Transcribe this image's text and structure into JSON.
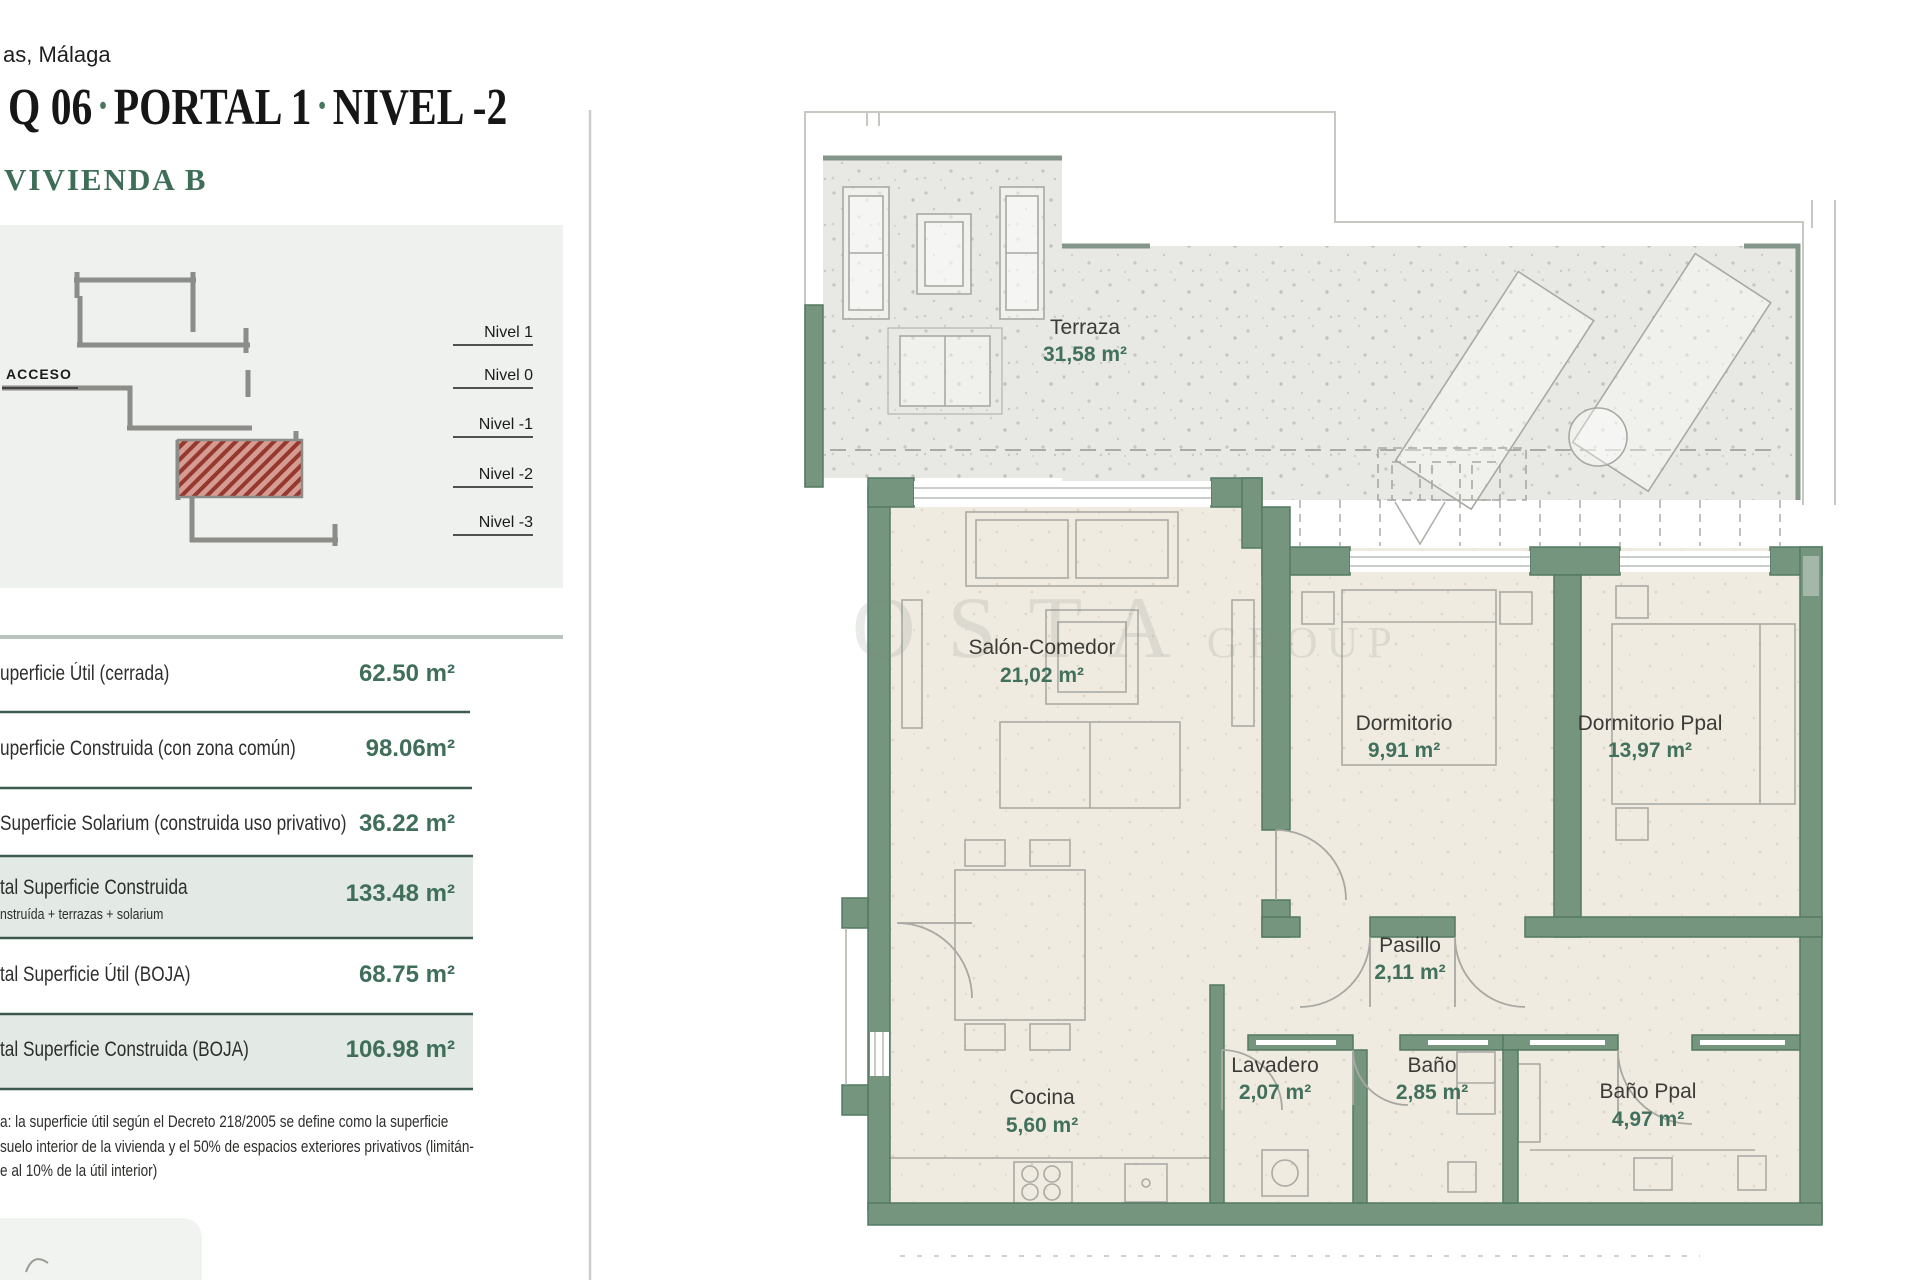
{
  "header": {
    "location": "as, Málaga",
    "title_parts": [
      "Q 06",
      "PORTAL 1",
      "NIVEL -2"
    ],
    "separator": "·",
    "unit": "VIVIENDA B"
  },
  "section_diagram": {
    "acceso_label": "ACCESO",
    "levels": [
      "Nivel 1",
      "Nivel 0",
      "Nivel -1",
      "Nivel -2",
      "Nivel -3"
    ],
    "highlighted_level": "Nivel -2"
  },
  "areas_table": {
    "rows": [
      {
        "label": "uperficie Útil (cerrada)",
        "value": "62.50 m²",
        "highlight": false
      },
      {
        "label": "uperficie Construida (con zona común)",
        "value": "98.06m²",
        "highlight": false
      },
      {
        "label": "Superficie Solarium (construida uso privativo)",
        "value": "36.22 m²",
        "highlight": false
      },
      {
        "label": "tal Superficie Construida",
        "sublabel": "nstruída + terrazas + solarium",
        "value": "133.48 m²",
        "highlight": true
      },
      {
        "label": "tal Superficie Útil (BOJA)",
        "value": "68.75 m²",
        "highlight": false
      },
      {
        "label": "tal Superficie Construida (BOJA)",
        "value": "106.98 m²",
        "highlight": true
      }
    ]
  },
  "footnote_lines": [
    "a: la superficie útil según el Decreto 218/2005 se define como la superficie",
    "suelo interior de la vivienda y el 50% de espacios exteriores privativos (limitán-",
    "e al 10% de la útil interior)"
  ],
  "watermark": {
    "big": "OSTA",
    "small": "GROUP"
  },
  "plan": {
    "rooms": [
      {
        "name": "Terraza",
        "area": "31,58 m²"
      },
      {
        "name": "Salón-Comedor",
        "area": "21,02 m²"
      },
      {
        "name": "Dormitorio",
        "area": "9,91 m²"
      },
      {
        "name": "Dormitorio Ppal",
        "area": "13,97 m²"
      },
      {
        "name": "Pasillo",
        "area": "2,11 m²"
      },
      {
        "name": "Cocina",
        "area": "5,60 m²"
      },
      {
        "name": "Lavadero",
        "area": "2,07 m²"
      },
      {
        "name": "Baño",
        "area": "2,85 m²"
      },
      {
        "name": "Baño Ppal",
        "area": "4,97 m²"
      }
    ]
  },
  "colors": {
    "wall_green": "#76957f",
    "accent_green": "#40715c",
    "band_green": "#e3e9e4",
    "separator_green": "#3c5a4d",
    "terrace_gray": "#e8e8e4",
    "room_beige": "#f0ebe1",
    "section_red": "#a24a40"
  }
}
